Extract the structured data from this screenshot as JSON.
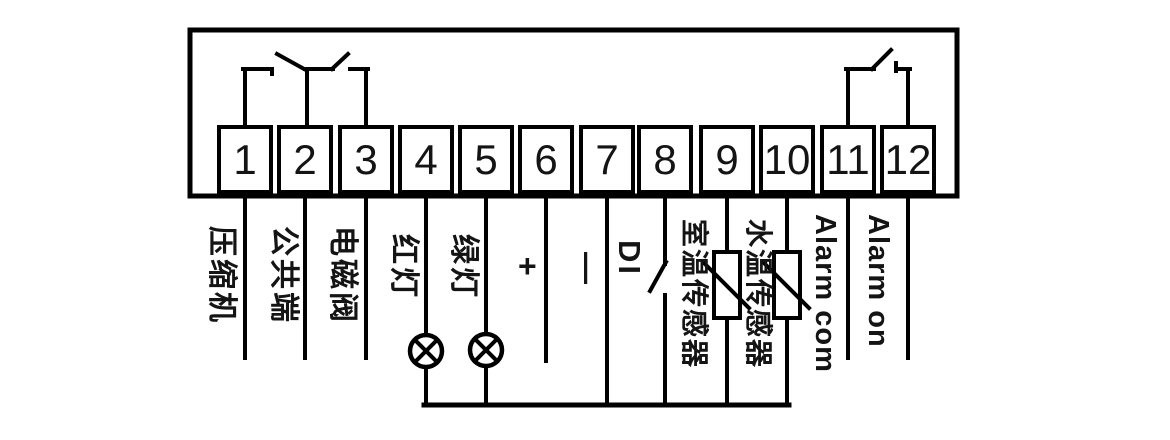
{
  "diagram": {
    "kind": "terminal-wiring-diagram",
    "background": "#ffffff",
    "line_color": "#000000",
    "terminals": [
      {
        "no": "1",
        "label": "压缩机"
      },
      {
        "no": "2",
        "label": "公共端"
      },
      {
        "no": "3",
        "label": "电磁阀"
      },
      {
        "no": "4",
        "label": "红灯"
      },
      {
        "no": "5",
        "label": "绿灯"
      },
      {
        "no": "6",
        "label": "+"
      },
      {
        "no": "7",
        "label": "—"
      },
      {
        "no": "8",
        "label": "DI"
      },
      {
        "no": "9",
        "label": "室温传感器"
      },
      {
        "no": "10",
        "label": "水温传感器"
      },
      {
        "no": "11",
        "label": "Alarm com"
      },
      {
        "no": "12",
        "label": "Alarm on"
      }
    ],
    "symbols": [
      {
        "name": "relay-contact-left",
        "terminals": "1-2-3",
        "type": "changeover-contact"
      },
      {
        "name": "relay-contact-right",
        "terminals": "11-12",
        "type": "normally-open-contact"
      },
      {
        "name": "red-lamp-icon",
        "terminal": "4",
        "type": "indicator-lamp"
      },
      {
        "name": "green-lamp-icon",
        "terminal": "5",
        "type": "indicator-lamp"
      },
      {
        "name": "di-switch-icon",
        "terminal": "8",
        "type": "switch-contact"
      },
      {
        "name": "room-temp-sensor-icon",
        "terminal": "9",
        "type": "thermistor"
      },
      {
        "name": "water-temp-sensor-icon",
        "terminal": "10",
        "type": "thermistor"
      }
    ]
  }
}
